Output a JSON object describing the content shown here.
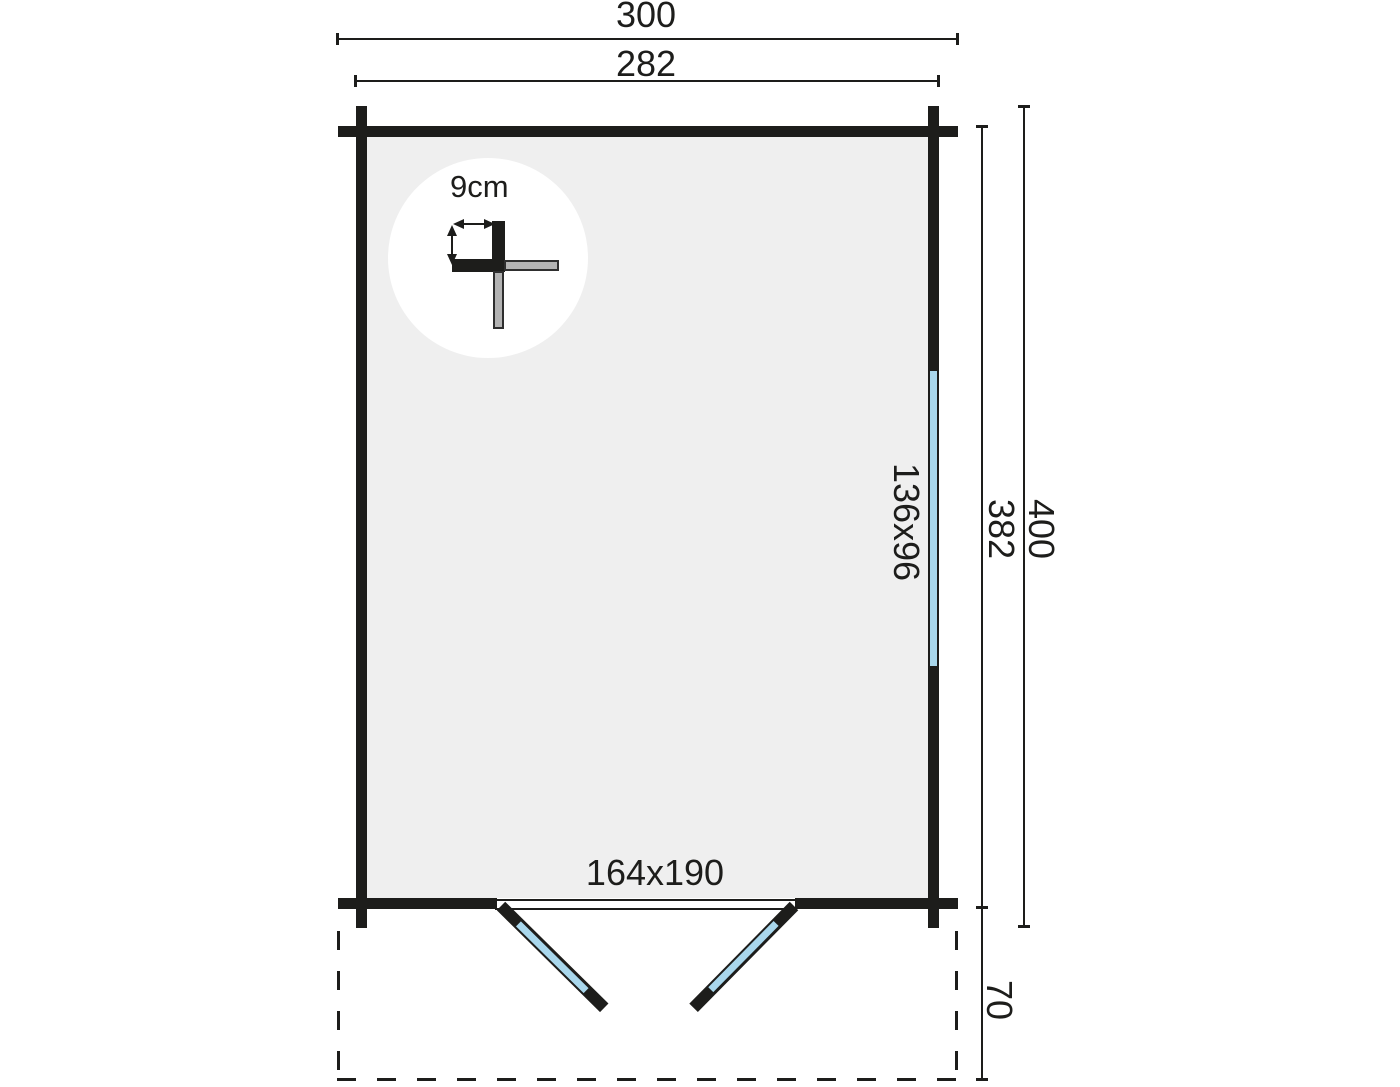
{
  "floor_plan": {
    "dimensions": {
      "overall_width": "300",
      "inner_width": "282",
      "inner_depth": "382",
      "overall_depth": "400",
      "canopy_depth": "70"
    },
    "window_label": "136x96",
    "door_label": "164x190",
    "wall_thickness_label": "9cm",
    "colors": {
      "wall": "#1d1d1b",
      "floor": "#efefef",
      "glazing": "#a9d7ec",
      "log_end_gray": "#b3b3b3",
      "background": "#ffffff"
    }
  }
}
